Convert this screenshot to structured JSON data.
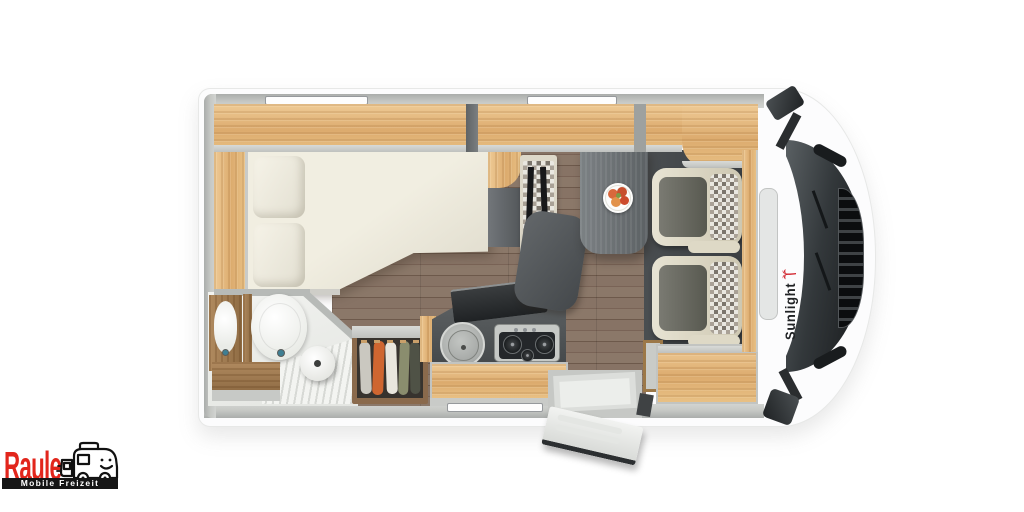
{
  "branding": {
    "manufacturer": {
      "name": "Sunlight",
      "logo_icon": "palm-tree-icon",
      "text_color": "#212325",
      "icon_color": "#d1202a"
    },
    "dealer": {
      "name": "Raule",
      "tagline": "Mobile Freizeit",
      "name_color": "#e2261c",
      "bar_bg": "#161616",
      "bar_text_color": "#ffffff",
      "icon": "motorhome-cartoon-icon"
    }
  },
  "scene": {
    "view": "top-down motorhome floor plan render",
    "palette": {
      "body": "#fcfcfd",
      "walls": "#b5b8b6",
      "oak_wood": "#e3b77e",
      "walnut_wood": "#9b7a58",
      "floor": "#7d6a59",
      "cab_floor": "#43474a",
      "mattress": "#ece9db",
      "table": "#6b7074",
      "kitchen_counter": "#4e5254",
      "seat_cream": "#ddd8c6",
      "seat_gray": "#6b6c64",
      "clothes": [
        "#cac8c0",
        "#cf6630",
        "#e9e6dd",
        "#8a8d6e",
        "#4f5246"
      ],
      "fruit_plate": [
        "#d8683c",
        "#c74f2e",
        "#e2924a",
        "#cc4b2c",
        "#7c9a45"
      ]
    }
  }
}
